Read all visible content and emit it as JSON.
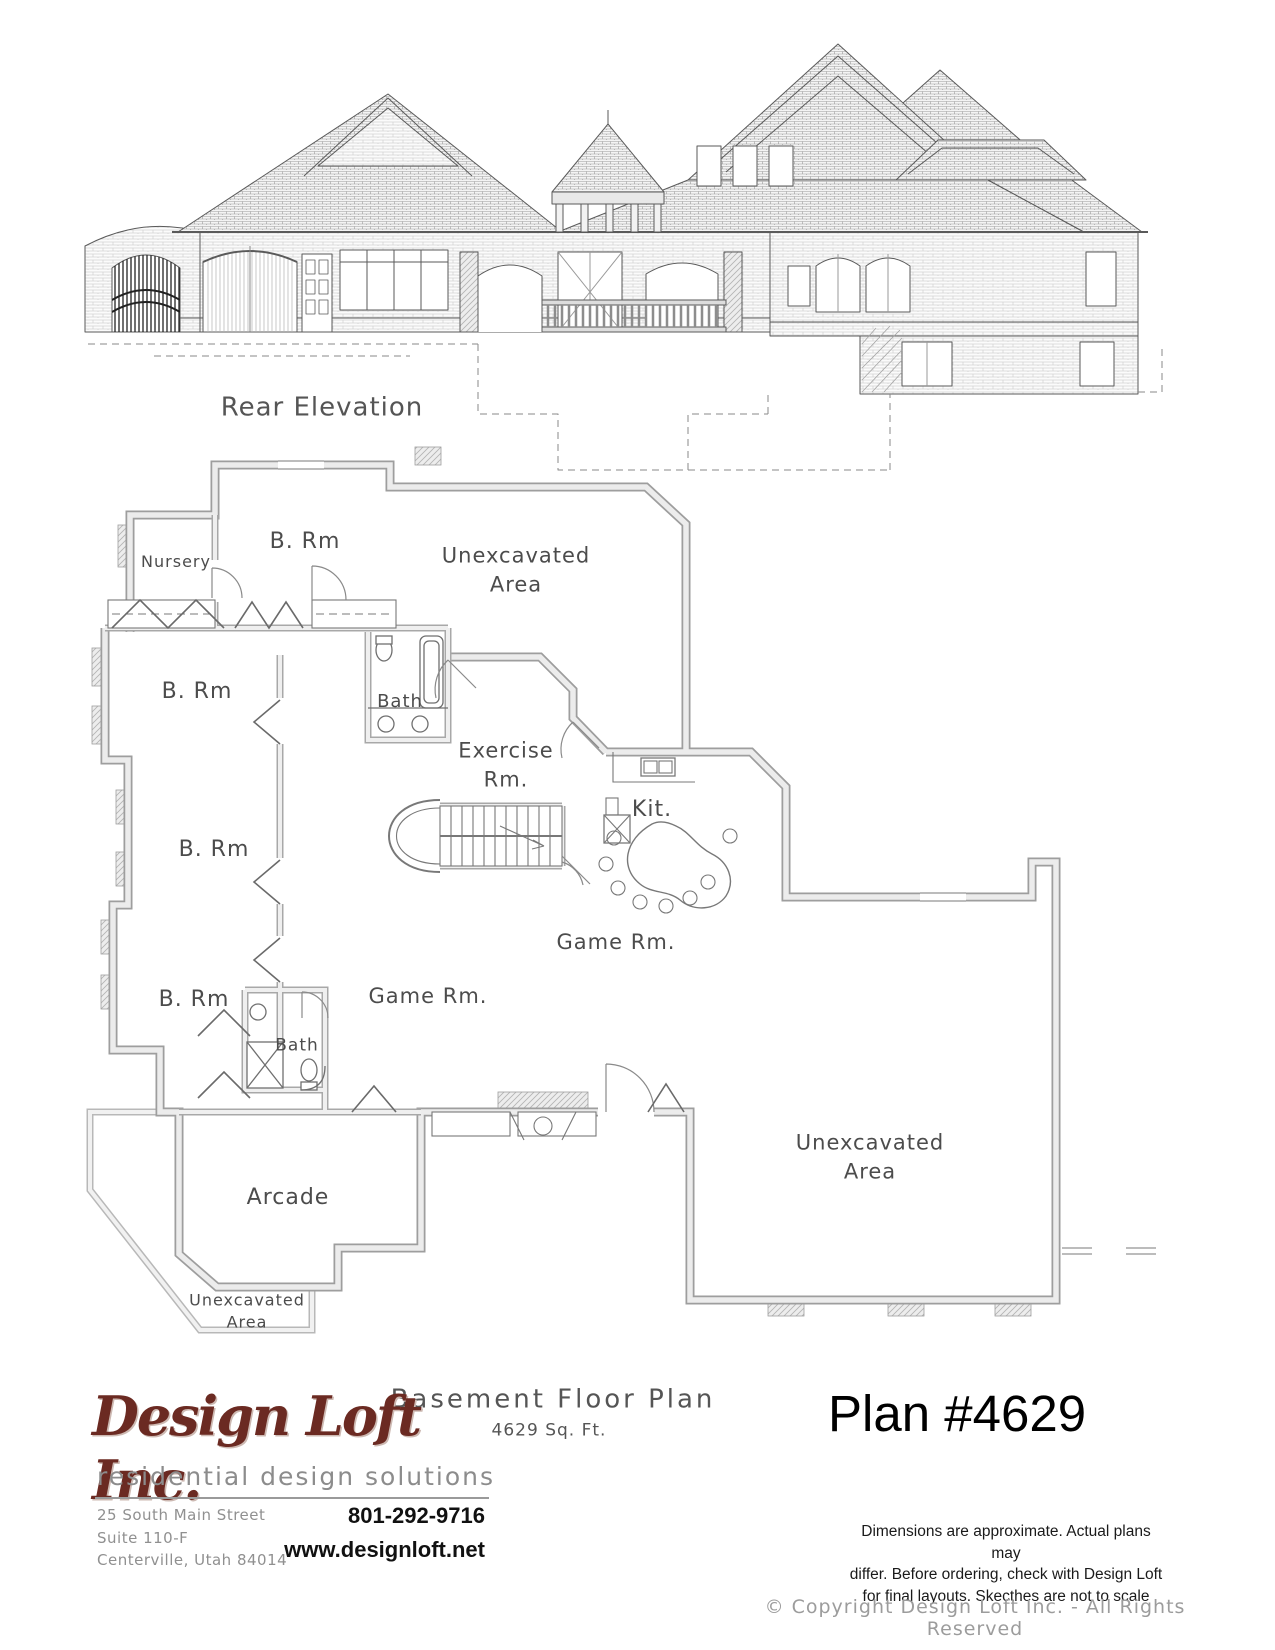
{
  "page": {
    "background": "#ffffff"
  },
  "elevation": {
    "title": "Rear Elevation"
  },
  "floor_plan": {
    "title": "Basement Floor Plan",
    "area_label": "4629 Sq. Ft.",
    "rooms": [
      {
        "label": "Nursery"
      },
      {
        "label": "B. Rm"
      },
      {
        "label": "Unexcavated",
        "label2": "Area"
      },
      {
        "label": "Bath"
      },
      {
        "label": "Exercise",
        "label2": "Rm."
      },
      {
        "label": "Kit."
      },
      {
        "label": "B. Rm"
      },
      {
        "label": "B. Rm"
      },
      {
        "label": "B. Rm"
      },
      {
        "label": "Bath"
      },
      {
        "label": "Game Rm."
      },
      {
        "label": "Game Rm."
      },
      {
        "label": "Arcade"
      },
      {
        "label": "Unexcavated",
        "label2": "Area"
      },
      {
        "label": "Unexcavated",
        "label2": "Area"
      }
    ]
  },
  "footer": {
    "logo_text": "Design Loft Inc.",
    "tagline": "residential design solutions",
    "address_line1": "25 South Main Street",
    "address_line2": "Suite 110-F",
    "address_line3": "Centerville, Utah 84014",
    "phone": "801-292-9716",
    "website": "www.designloft.net",
    "plan_number": "Plan #4629",
    "disclaimer_line1": "Dimensions are approximate.  Actual plans may",
    "disclaimer_line2": "differ.  Before ordering, check with Design Loft",
    "disclaimer_line3": "for final layouts.  Skecthes are not to scale",
    "copyright": "© Copyright Design Loft Inc. - All Rights Reserved"
  },
  "colors": {
    "logo": "#6b2a22",
    "line_art": "#555555",
    "wall_fill": "#ececec",
    "text_gray": "#909090"
  }
}
